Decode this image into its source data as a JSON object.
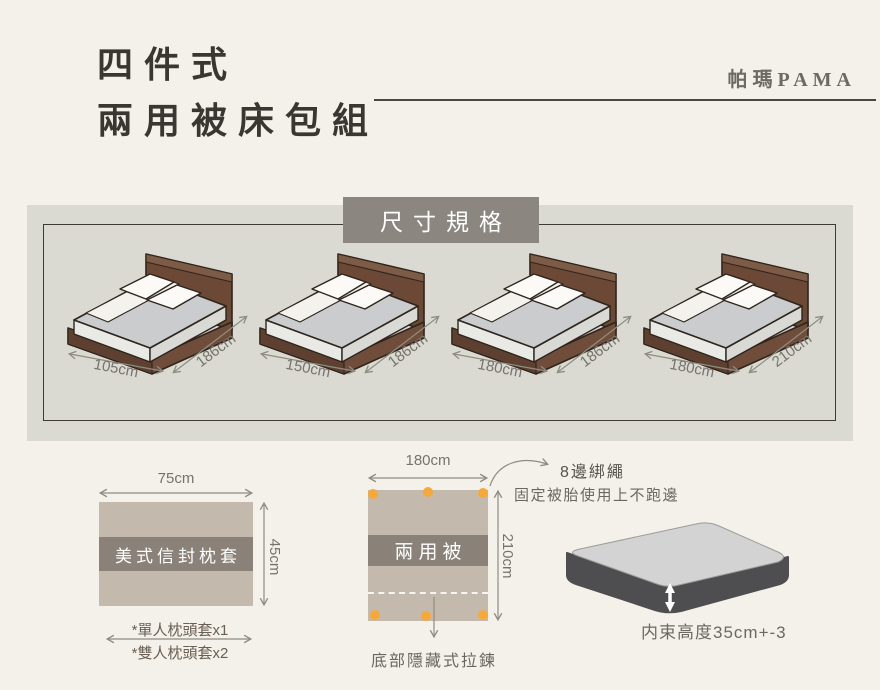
{
  "header": {
    "title_line1": "四件式",
    "title_line2": "兩用被床包組",
    "brand": "帕瑪PAMA"
  },
  "size_section": {
    "heading": "尺寸規格",
    "beds": [
      {
        "width": "105cm",
        "length": "186cm"
      },
      {
        "width": "150cm",
        "length": "186cm"
      },
      {
        "width": "180cm",
        "length": "186cm"
      },
      {
        "width": "180cm",
        "length": "210cm"
      }
    ]
  },
  "pillow": {
    "name": "美式信封枕套",
    "width_label": "75cm",
    "height_label": "45cm",
    "note_single": "*單人枕頭套x1",
    "note_double": "*雙人枕頭套x2"
  },
  "duvet": {
    "name": "兩用被",
    "width_label": "180cm",
    "height_label": "210cm",
    "tie_title": "8邊綁繩",
    "tie_desc": "固定被胎使用上不跑邊",
    "zipper_note": "底部隱藏式拉鍊",
    "tie_dot_count": 8
  },
  "mattress": {
    "height_note": "内束高度35cm+-3"
  },
  "colors": {
    "page_bg": "#f3f1e9",
    "panel_gray": "#dbdad2",
    "heading_gray": "#8b8680",
    "fabric_tan": "#c3b9ad",
    "band_gray": "#8a8178",
    "dot_orange": "#f6a93b",
    "bed_brown": "#6b4936",
    "dim_gray": "#8f8d82"
  }
}
